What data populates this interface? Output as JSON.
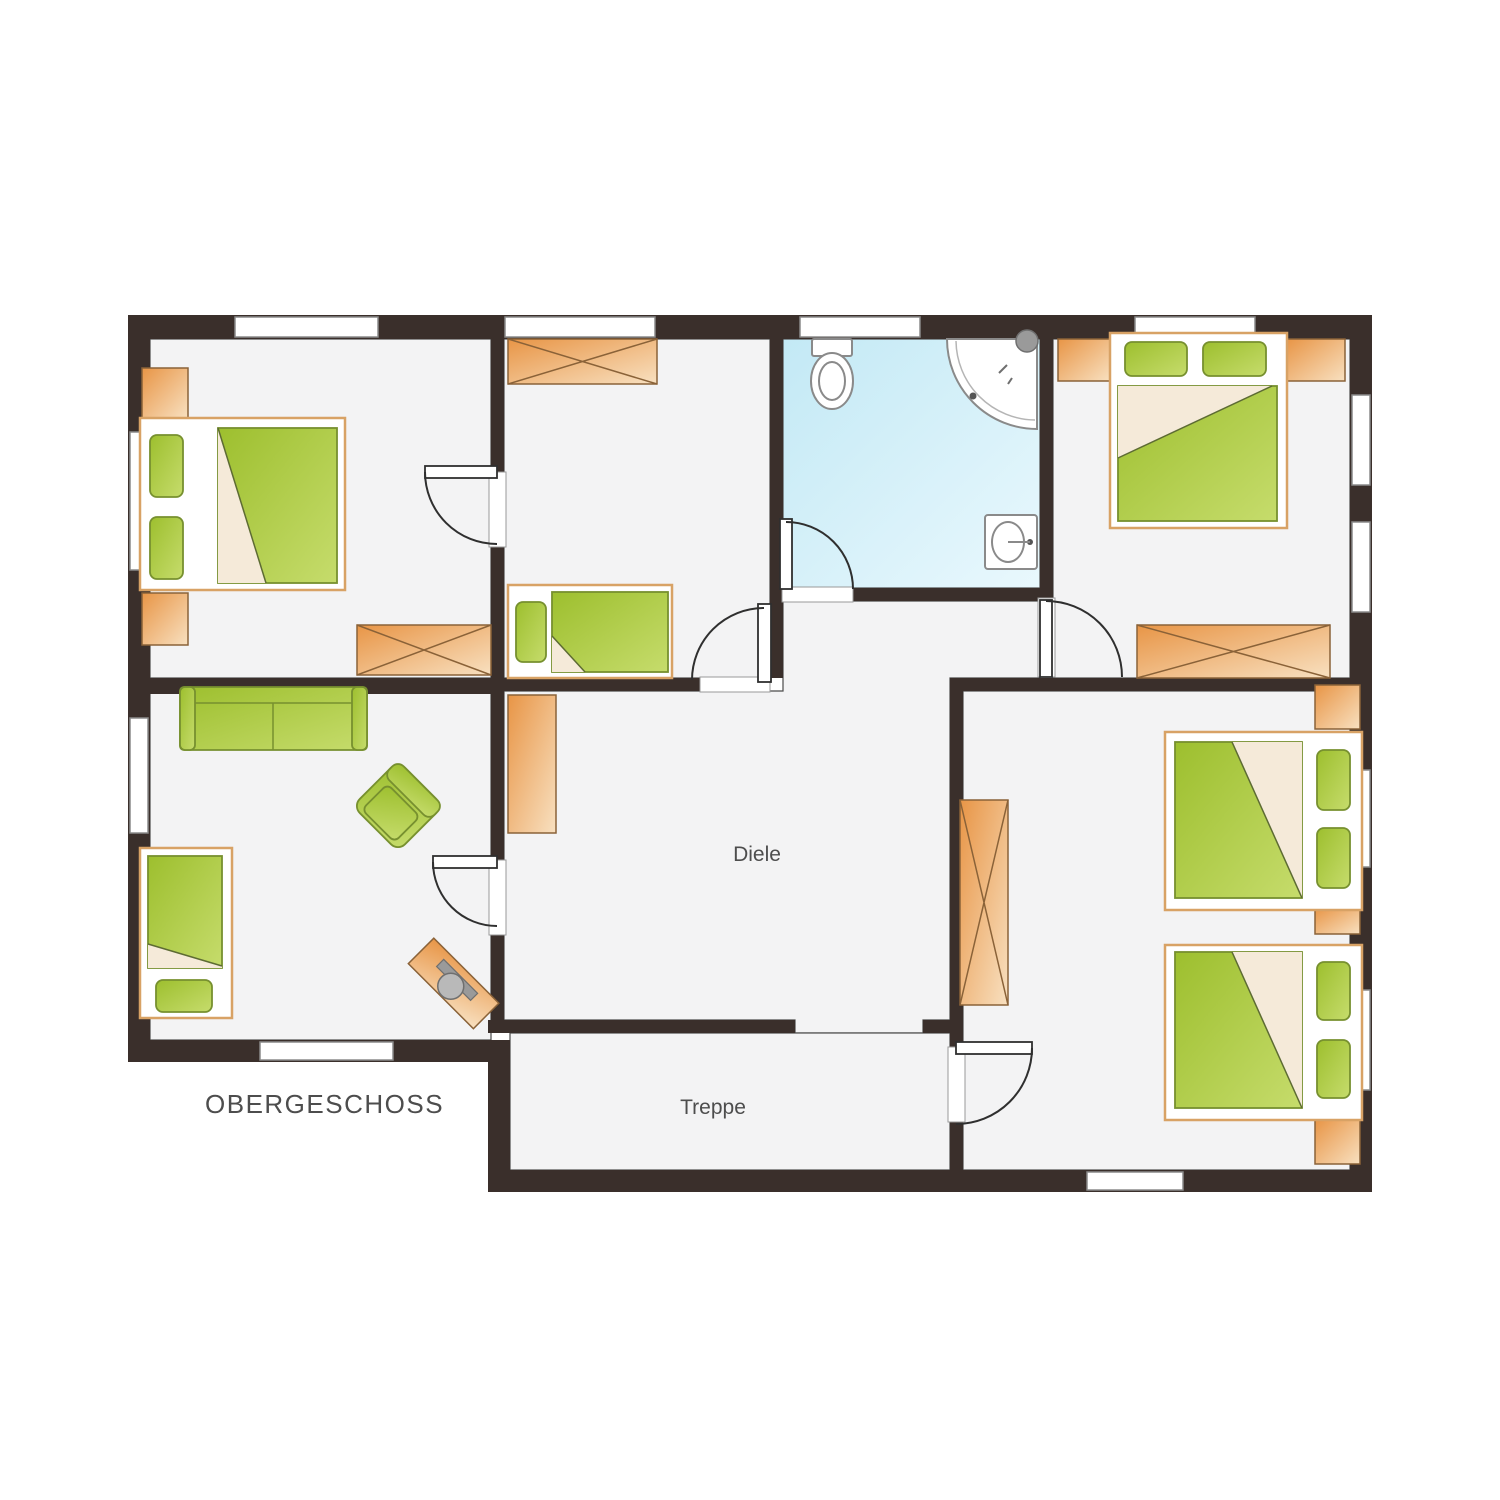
{
  "floorplan": {
    "title": "OBERGESCHOSS",
    "labels": {
      "hallway": "Diele",
      "stairs": "Treppe"
    },
    "rooms": [
      {
        "id": "bedroom-top-left",
        "furniture": [
          "double-bed",
          "wardrobe",
          "nightstand",
          "dresser",
          "door"
        ]
      },
      {
        "id": "bedroom-middle",
        "furniture": [
          "single-bed",
          "wardrobe",
          "door"
        ]
      },
      {
        "id": "bathroom",
        "furniture": [
          "toilet",
          "corner-shower",
          "sink",
          "door"
        ]
      },
      {
        "id": "bedroom-top-right",
        "furniture": [
          "double-bed",
          "nightstand",
          "nightstand",
          "wardrobe",
          "door"
        ]
      },
      {
        "id": "living-room-bottom-left",
        "furniture": [
          "sofa",
          "armchair",
          "single-bed",
          "desk-with-chair",
          "door"
        ]
      },
      {
        "id": "hallway",
        "furniture": [
          "cabinet"
        ]
      },
      {
        "id": "bedroom-bottom-right",
        "furniture": [
          "double-bed",
          "double-bed",
          "wardrobe",
          "nightstand",
          "door"
        ]
      },
      {
        "id": "staircase",
        "furniture": []
      }
    ]
  },
  "colors": {
    "wall": "#3a2f2b",
    "floor": "#f3f3f4",
    "bath1": "#c3e9f5",
    "bath2": "#e9f8fd",
    "orange1": "#e89546",
    "orange2": "#f8e0c0",
    "orange-border": "#8a6238",
    "green1": "#9dbf2e",
    "green2": "#c6dc6c",
    "green-border": "#77902f",
    "frame": "#d8a265",
    "fold": "#f5ead9",
    "fixture": "#8a8a8a",
    "door": "#2f2f2f",
    "text": "#4d4d4d"
  }
}
